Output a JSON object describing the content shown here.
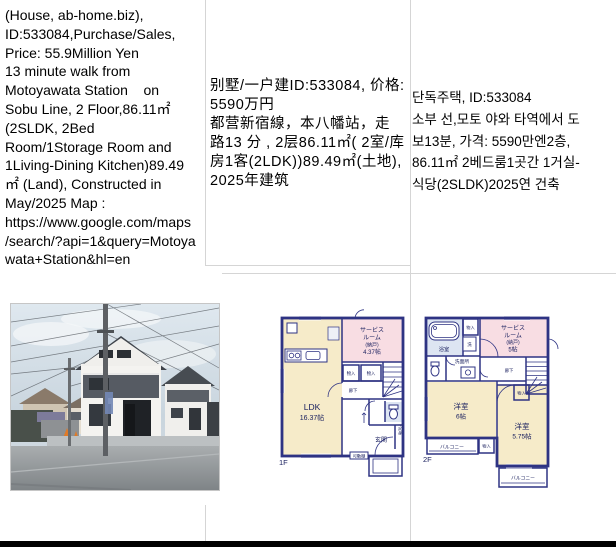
{
  "table": {
    "row1": {
      "en": "(House, ab-home.biz),\nID:533084,Purchase/Sales,\nPrice: 55.9Million Yen\n13 minute walk from\nMotoyawata Station    on\nSobu Line, 2 Floor,86.11㎡\n(2SLDK, 2Bed\nRoom/1Storage Room and\n1Living-Dining Kitchen)89.49\n㎡ (Land), Constructed in\nMay/2025 Map :\nhttps://www.google.com/maps\n/search/?api=1&query=Motoya\nwata+Station&hl=en",
      "zh": "别墅/一户建ID:533084, 价格:\n5590万円\n都营新宿線，本八幡站，走\n路13 分 , 2层86.11㎡( 2室/库\n房1客(2LDK))89.49㎡(土地),\n2025年建筑",
      "ko": "단독주택, ID:533084\n소부 선,모토 야와 타역에서 도\n보13분, 가격: 5590만엔2층,\n86.11㎡ 2베드룸1곳간 1거실-\n식당(2SLDK)2025연 건축"
    }
  },
  "floorplan_1f": {
    "floor_label": "1F",
    "ldk_label": "LDK",
    "ldk_size": "16.37帖",
    "service_line1": "サービス",
    "service_line2": "ルーム",
    "service_line3": "(納戸)",
    "service_size": "4.37帖",
    "closet_a": "物入",
    "closet_b": "物入",
    "hall": "廊下",
    "entrance": "玄関",
    "shoebox": "下足箱",
    "shelf": "可動棚"
  },
  "floorplan_2f": {
    "floor_label": "2F",
    "bath": "浴室",
    "laundry": "洗",
    "washroom": "洗面所",
    "closet_a": "物入",
    "closet_b": "物入",
    "closet_c": "物入",
    "service_line1": "サービス",
    "service_line2": "ルーム",
    "service_line3": "(納戸)",
    "service_size": "5帖",
    "hall": "廊下",
    "room1": "洋室",
    "room1_size": "6帖",
    "room2": "洋室",
    "room2_size": "5.75帖",
    "balcony_left": "バルコニー",
    "balcony_right": "バルコニー"
  },
  "colors": {
    "wall_navy": "#2e3383",
    "room_cream": "#f6ebc9",
    "room_pink": "#f8dde3",
    "room_blue": "#dde5f2",
    "grid_line": "#d5d5d5",
    "bottom_bar": "#000000"
  }
}
